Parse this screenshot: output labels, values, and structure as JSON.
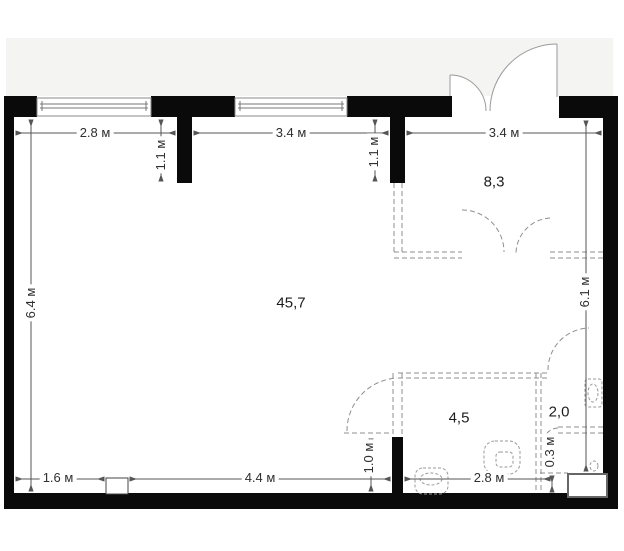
{
  "plan": {
    "title": "apartment-floor-plan",
    "dimensions": {
      "top_left": "2.8 м",
      "top_mid": "3.4 м",
      "top_right": "3.4 м",
      "pier_left": "1.1 м",
      "pier_right": "1.1 м",
      "left_side": "6.4 м",
      "right_side": "6.1 м",
      "bottom_left": "1.6 м",
      "bottom_mid": "4.4 м",
      "bottom_right": "2.8 м",
      "bath_door": "1.0 м",
      "corner_niche": "0.3 м"
    },
    "areas": {
      "living_room": "45,7",
      "hallway": "8,3",
      "bathroom": "4,5",
      "wc": "2,0"
    },
    "colors": {
      "wall": "#0a0a0a",
      "exterior_band": "#f4f4f2",
      "dimension_line": "#555555",
      "dashed_outline": "#8f8f8f"
    }
  }
}
